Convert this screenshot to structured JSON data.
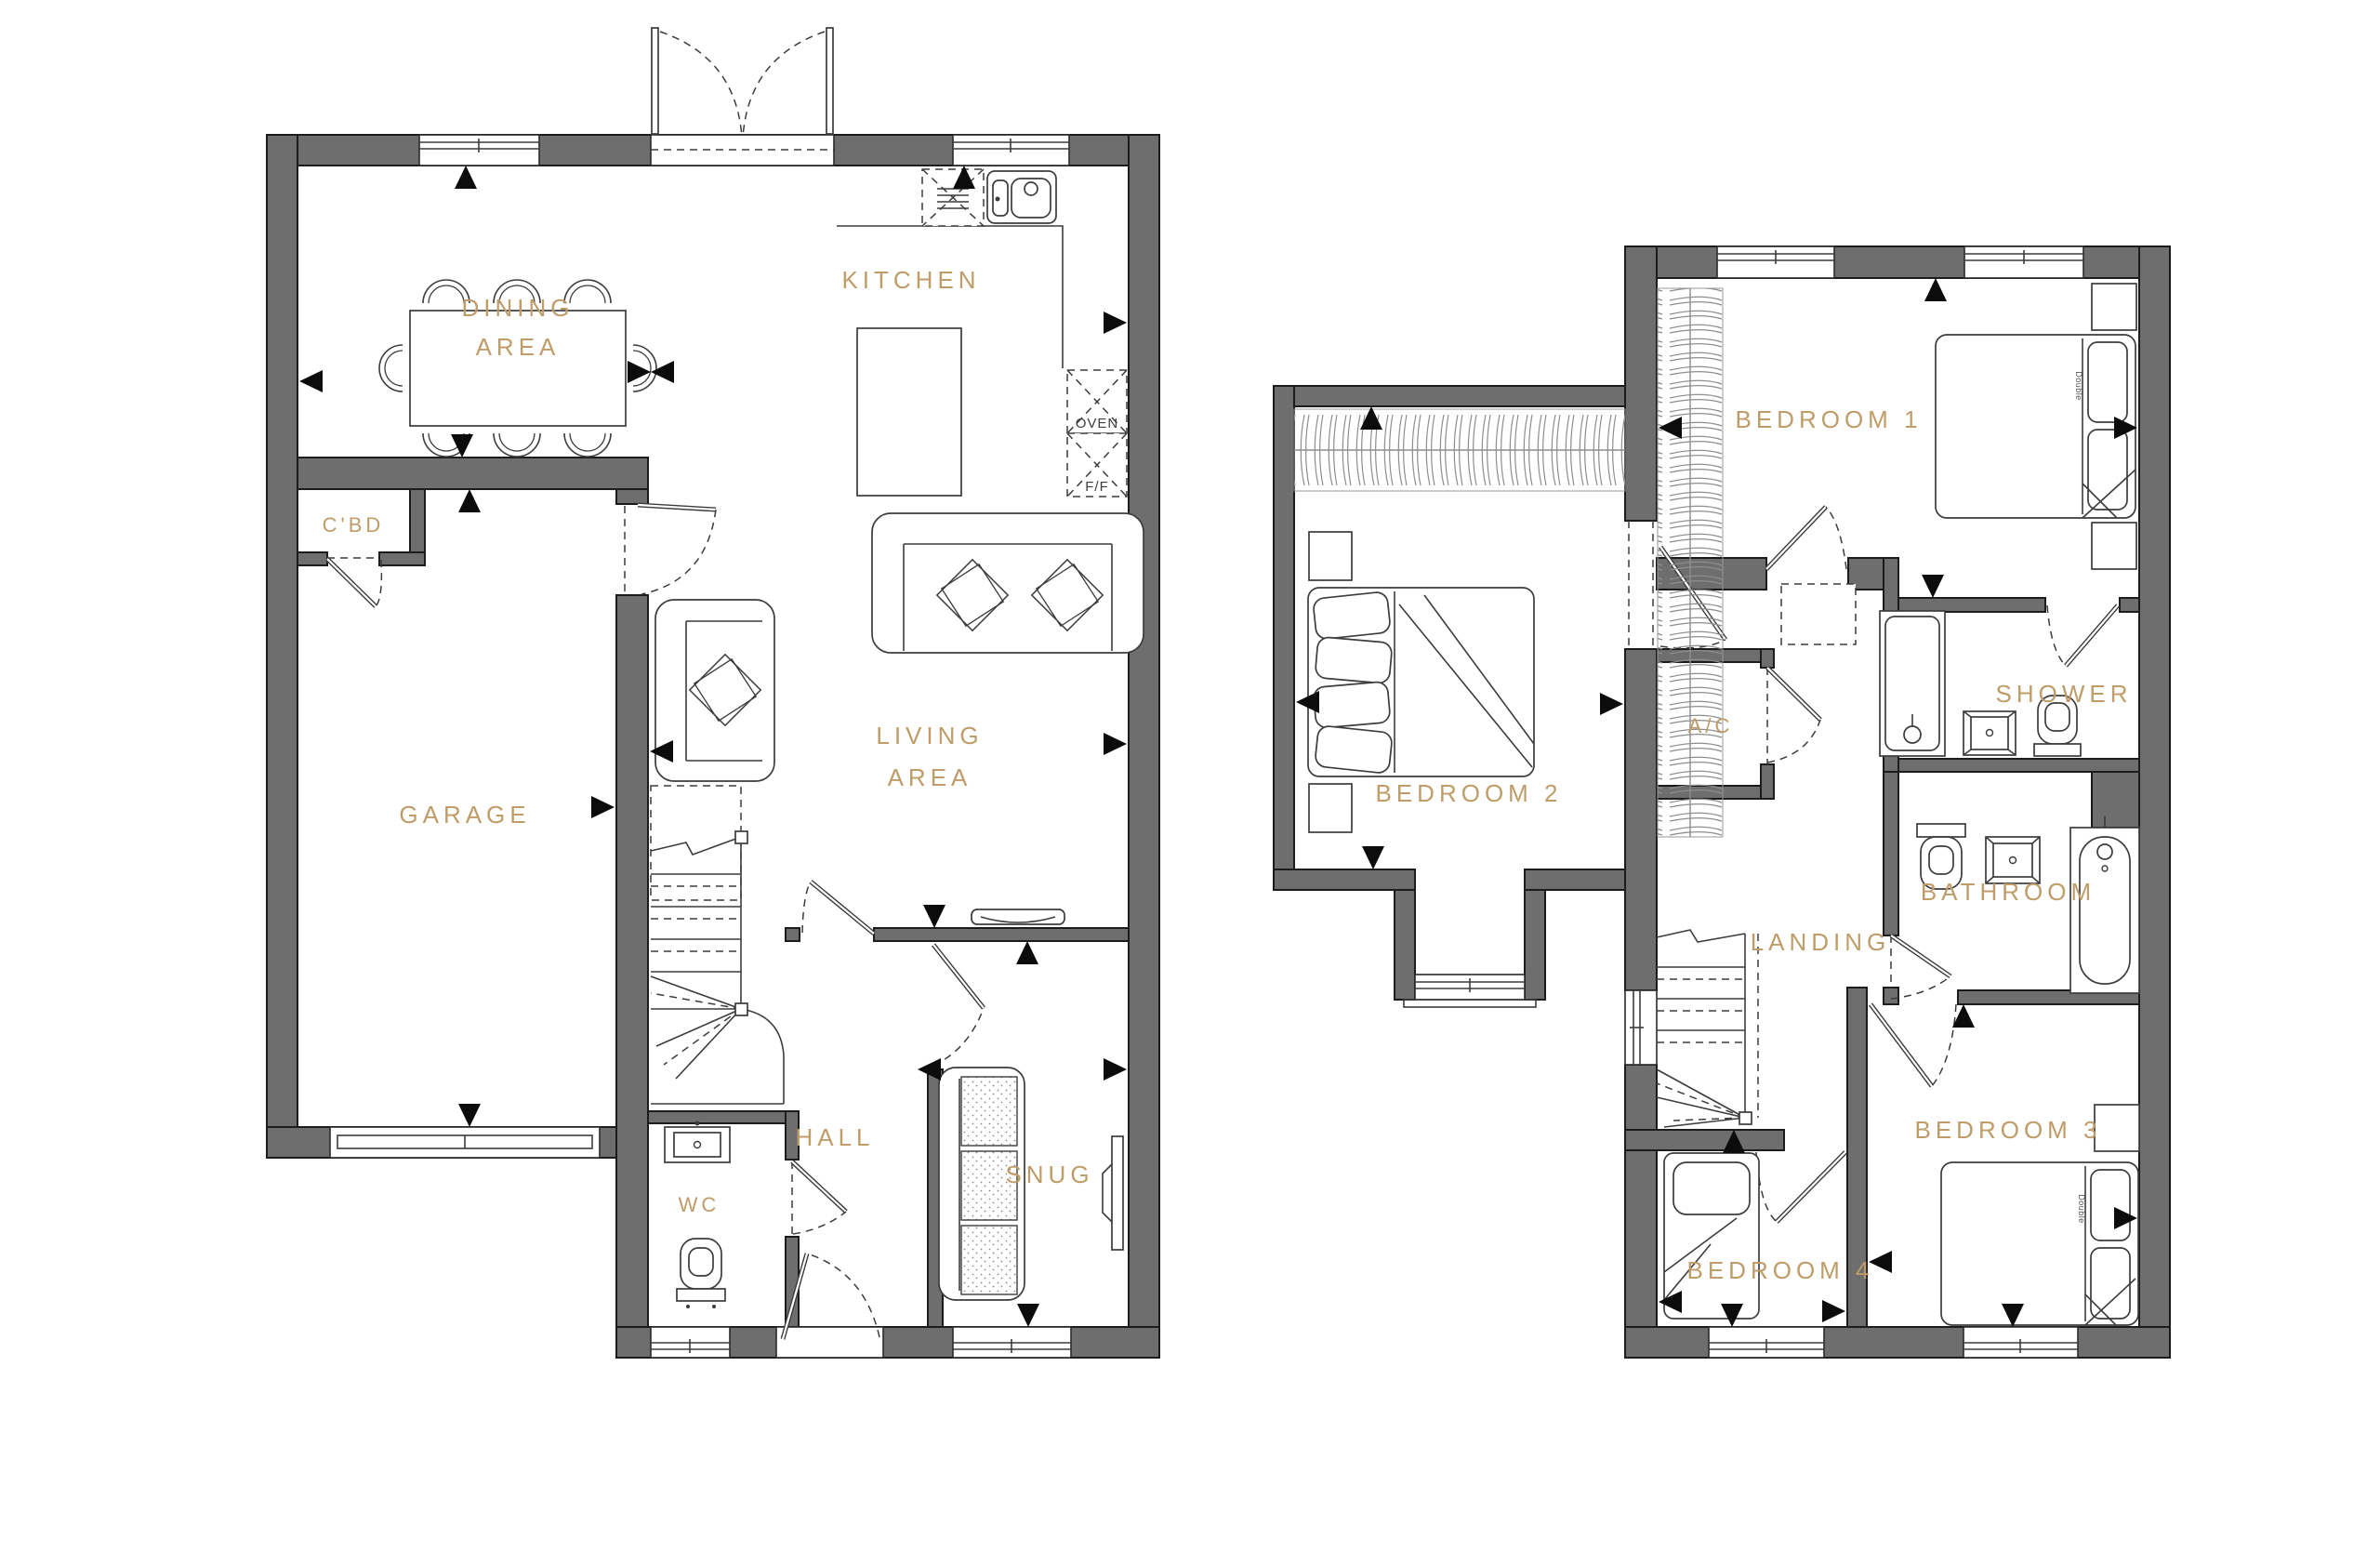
{
  "palette": {
    "wall_fill": "#6e6e6e",
    "label_color": "#bf9c68",
    "line_color": "#3c3c3c",
    "arrow_color": "#0c0c0c",
    "background": "#ffffff"
  },
  "ground_floor": {
    "rooms": {
      "dining_line1": "DINING",
      "dining_line2": "AREA",
      "kitchen": "KITCHEN",
      "cupboard": "C'BD",
      "garage": "GARAGE",
      "living_line1": "LIVING",
      "living_line2": "AREA",
      "hall": "HALL",
      "wc": "WC",
      "snug": "SNUG"
    },
    "appliances": {
      "oven": "OVEN",
      "fridge_freezer": "F/F"
    }
  },
  "first_floor": {
    "rooms": {
      "bedroom1": "BEDROOM 1",
      "bedroom2": "BEDROOM 2",
      "bedroom3": "BEDROOM 3",
      "bedroom4": "BEDROOM 4",
      "airing_cupboard": "A/C",
      "shower": "SHOWER",
      "landing": "LANDING",
      "bathroom": "BATHROOM"
    },
    "bed_size_label": "Double"
  }
}
